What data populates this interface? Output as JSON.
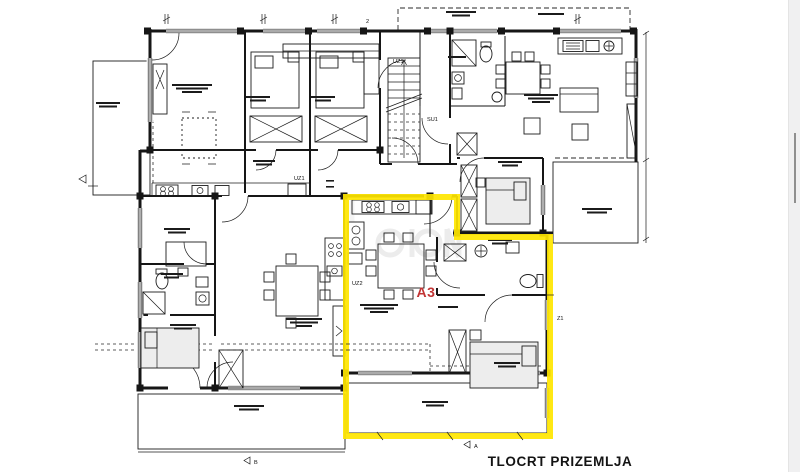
{
  "document": {
    "title": "TLOCRT PRIZEMLJA",
    "apartment_highlight": {
      "label": "A3",
      "label_color": "#c23535",
      "outline_color": "#ffe600"
    },
    "annotations": {
      "stair_label": "SU1",
      "door_label_top": "UZ1",
      "door_label_mid": "UZ1",
      "door_label_left": "UZ2",
      "wall_label_right": "Z1",
      "dim_label_top": "2",
      "section_marker_a": "A",
      "section_marker_b": "B"
    },
    "colors": {
      "line": "#161616",
      "background": "#ffffff",
      "scrollbar_track": "#f0f0f1",
      "scrollbar_thumb": "#8f8f8f"
    }
  }
}
